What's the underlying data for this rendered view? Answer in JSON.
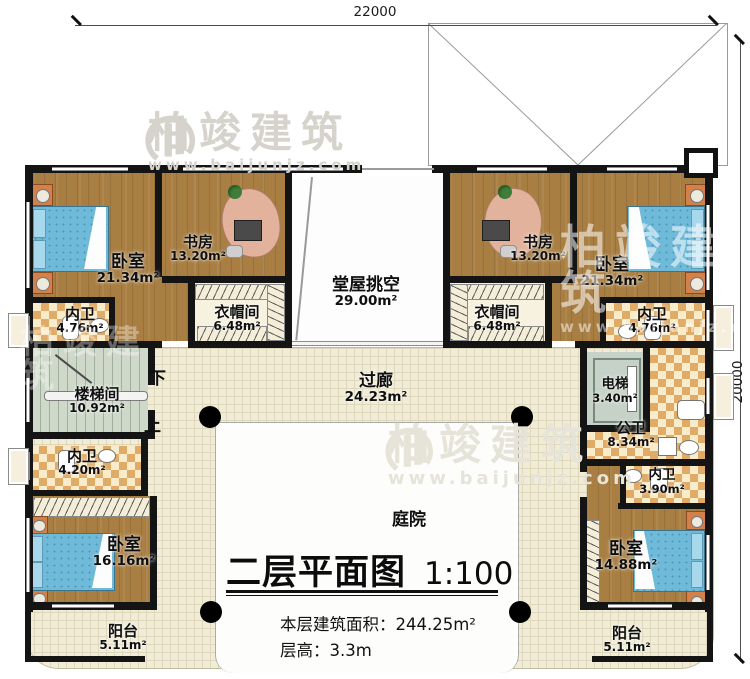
{
  "title": {
    "name": "二层平面图",
    "scale": "1:100"
  },
  "notes": {
    "area_label": "本层建筑面积：",
    "area_value": "244.25m²",
    "height_label": "层高：",
    "height_value": "3.3m"
  },
  "dimensions": {
    "top": "22000",
    "right": "20000"
  },
  "watermark": {
    "brand": "柏竣建筑",
    "url": "www.baijunjz.com"
  },
  "stairs": {
    "down": "下",
    "up": "上"
  },
  "rooms": {
    "bedroom_tl": {
      "label": "卧室",
      "area": "21.34m²"
    },
    "study_l": {
      "label": "书房",
      "area": "13.20m²"
    },
    "hall_void": {
      "label": "堂屋挑空",
      "area": "29.00m²"
    },
    "study_r": {
      "label": "书房",
      "area": "13.20m²"
    },
    "bedroom_tr": {
      "label": "卧室",
      "area": "21.34m²"
    },
    "bath_tl": {
      "label": "内卫",
      "area": "4.76m²"
    },
    "closet_l": {
      "label": "衣帽间",
      "area": "6.48m²"
    },
    "closet_r": {
      "label": "衣帽间",
      "area": "6.48m²"
    },
    "bath_tr": {
      "label": "内卫",
      "area": "4.76m²"
    },
    "corridor": {
      "label": "过廊",
      "area": "24.23m²"
    },
    "stairwell": {
      "label": "楼梯间",
      "area": "10.92m²"
    },
    "elevator": {
      "label": "电梯",
      "area": "3.40m²"
    },
    "bath_ml": {
      "label": "内卫",
      "area": "4.20m²"
    },
    "public_bath": {
      "label": "公卫",
      "area": "8.34m²"
    },
    "bath_mr": {
      "label": "内卫",
      "area": "3.90m²"
    },
    "bedroom_bl": {
      "label": "卧室",
      "area": "16.16m²"
    },
    "bedroom_br": {
      "label": "卧室",
      "area": "14.88m²"
    },
    "balcony_l": {
      "label": "阳台",
      "area": "5.11m²"
    },
    "balcony_r": {
      "label": "阳台",
      "area": "5.11m²"
    },
    "courtyard": {
      "label": "庭院",
      "area": ""
    }
  }
}
